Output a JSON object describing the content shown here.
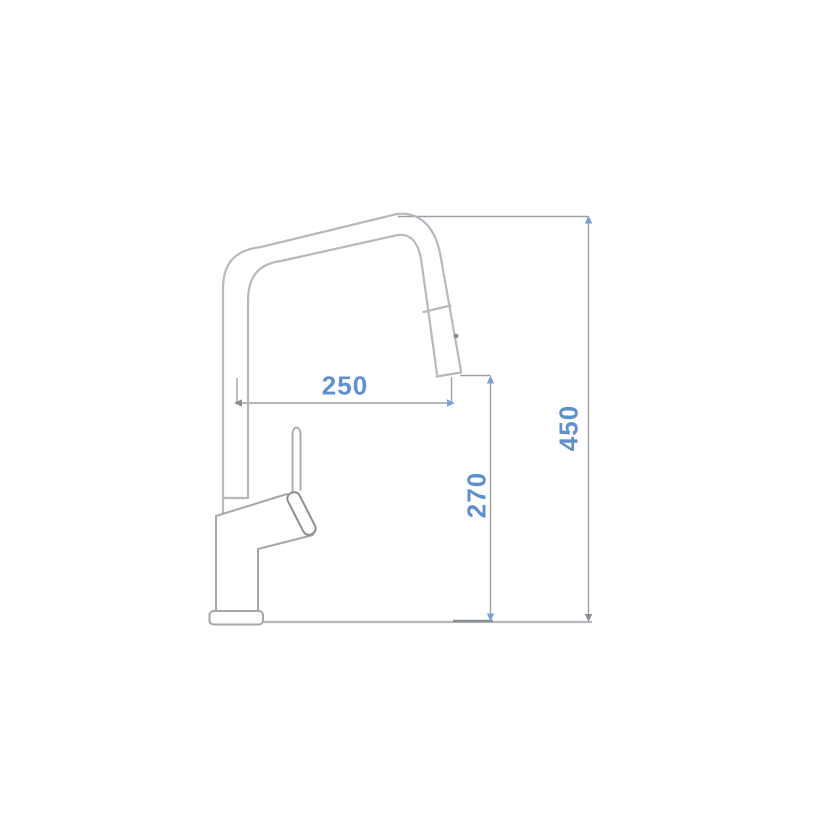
{
  "diagram": {
    "kind": "technical-dimension-drawing",
    "subject": "pull-out spray kitchen mixer tap, side elevation",
    "dimensions": {
      "reach": {
        "value": "250",
        "orientation": "horizontal"
      },
      "outlet_height": {
        "value": "270",
        "orientation": "vertical"
      },
      "overall_height": {
        "value": "450",
        "orientation": "vertical"
      }
    }
  },
  "colors": {
    "label-blue": "#6090cc",
    "arrow-blue": "#7ba1d7",
    "outline-gray": "#b6b9bd",
    "body-gray": "#a4a7ab",
    "dimension-gray": "#9ba1a7",
    "dark-gray": "#8a8f94",
    "background": "#ffffff"
  }
}
